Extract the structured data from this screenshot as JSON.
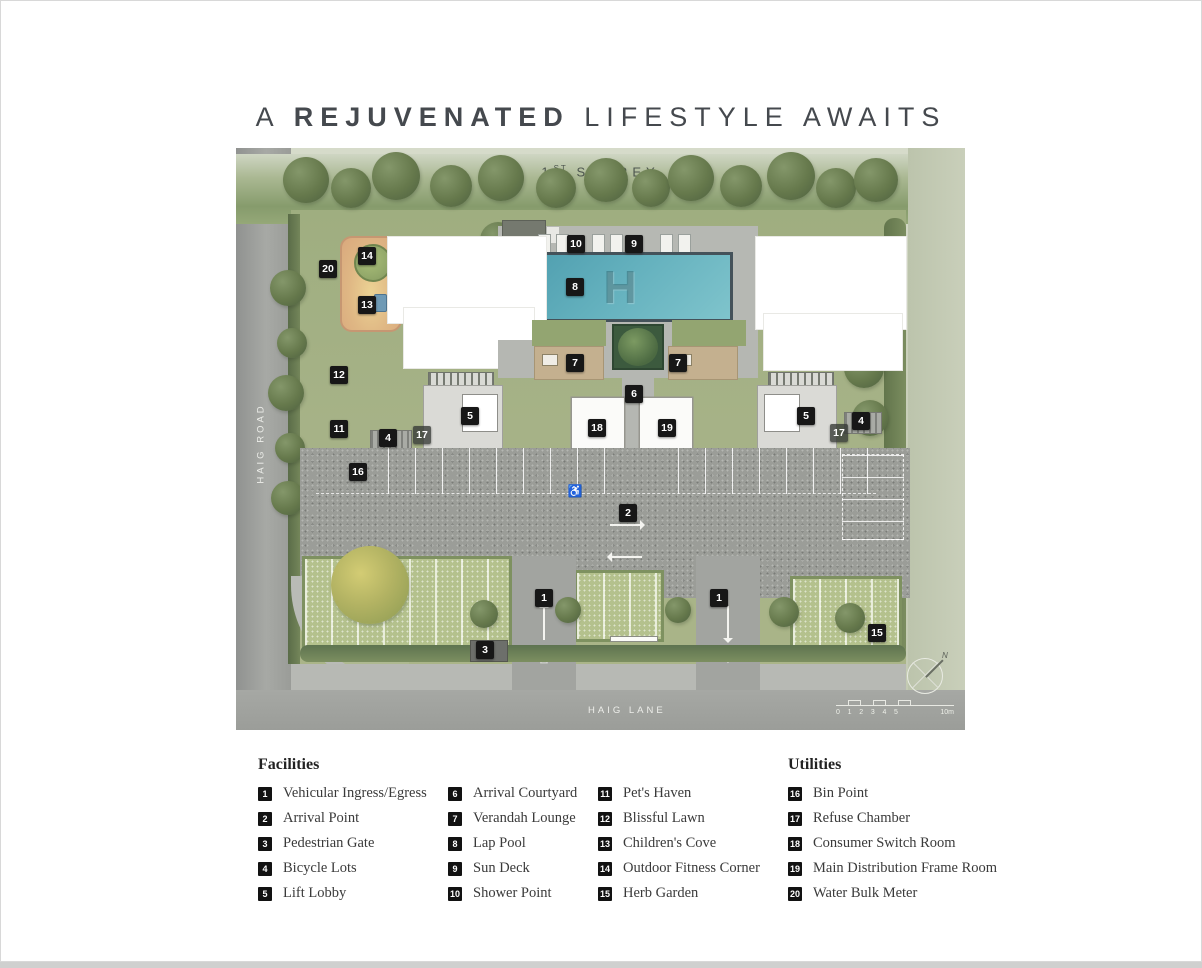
{
  "title": {
    "prefix": "A",
    "emphasis": "REJUVENATED",
    "suffix": "LIFESTYLE AWAITS"
  },
  "plan": {
    "storey_num": "1",
    "storey_sup": "ST",
    "storey_word": "STOREY",
    "road_left": "HAIG ROAD",
    "road_bottom": "HAIG LANE",
    "pool_monogram": "H",
    "ingress_label": "INGRESS",
    "egress_label": "EGRESS",
    "ingress_triangle": "△",
    "egress_triangle": "▽",
    "wheelchair_icon": "♿",
    "compass_n": "N",
    "scale": {
      "ticks": [
        "0",
        "1",
        "2",
        "3",
        "4",
        "5"
      ],
      "end_label": "10m"
    },
    "markers": [
      {
        "n": "20",
        "x": 92,
        "y": 121
      },
      {
        "n": "14",
        "x": 131,
        "y": 108
      },
      {
        "n": "13",
        "x": 131,
        "y": 157
      },
      {
        "n": "10",
        "x": 340,
        "y": 96
      },
      {
        "n": "9",
        "x": 398,
        "y": 96
      },
      {
        "n": "8",
        "x": 339,
        "y": 139
      },
      {
        "n": "7",
        "x": 339,
        "y": 215
      },
      {
        "n": "7",
        "x": 442,
        "y": 215
      },
      {
        "n": "6",
        "x": 398,
        "y": 246
      },
      {
        "n": "12",
        "x": 103,
        "y": 227
      },
      {
        "n": "11",
        "x": 103,
        "y": 281
      },
      {
        "n": "5",
        "x": 234,
        "y": 268
      },
      {
        "n": "17",
        "x": 186,
        "y": 287,
        "muted": true
      },
      {
        "n": "4",
        "x": 152,
        "y": 290
      },
      {
        "n": "18",
        "x": 361,
        "y": 280
      },
      {
        "n": "19",
        "x": 431,
        "y": 280
      },
      {
        "n": "5",
        "x": 570,
        "y": 268
      },
      {
        "n": "17",
        "x": 603,
        "y": 285,
        "muted": true
      },
      {
        "n": "4",
        "x": 625,
        "y": 273
      },
      {
        "n": "16",
        "x": 122,
        "y": 324
      },
      {
        "n": "2",
        "x": 392,
        "y": 365
      },
      {
        "n": "1",
        "x": 308,
        "y": 450
      },
      {
        "n": "1",
        "x": 483,
        "y": 450
      },
      {
        "n": "3",
        "x": 249,
        "y": 502
      },
      {
        "n": "15",
        "x": 641,
        "y": 485
      }
    ]
  },
  "legend": {
    "facilities_title": "Facilities",
    "utilities_title": "Utilities",
    "facilities": [
      {
        "num": "1",
        "label": "Vehicular Ingress/Egress"
      },
      {
        "num": "2",
        "label": "Arrival Point"
      },
      {
        "num": "3",
        "label": "Pedestrian Gate"
      },
      {
        "num": "4",
        "label": "Bicycle Lots"
      },
      {
        "num": "5",
        "label": "Lift Lobby"
      },
      {
        "num": "6",
        "label": "Arrival Courtyard"
      },
      {
        "num": "7",
        "label": "Verandah Lounge"
      },
      {
        "num": "8",
        "label": "Lap Pool"
      },
      {
        "num": "9",
        "label": "Sun Deck"
      },
      {
        "num": "10",
        "label": "Shower Point"
      },
      {
        "num": "11",
        "label": "Pet's Haven"
      },
      {
        "num": "12",
        "label": "Blissful Lawn"
      },
      {
        "num": "13",
        "label": "Children's Cove"
      },
      {
        "num": "14",
        "label": "Outdoor Fitness Corner"
      },
      {
        "num": "15",
        "label": "Herb Garden"
      }
    ],
    "utilities": [
      {
        "num": "16",
        "label": "Bin Point"
      },
      {
        "num": "17",
        "label": "Refuse Chamber"
      },
      {
        "num": "18",
        "label": "Consumer Switch Room"
      },
      {
        "num": "19",
        "label": "Main Distribution Frame Room"
      },
      {
        "num": "20",
        "label": "Water Bulk Meter"
      }
    ]
  },
  "colors": {
    "title_text": "#45494e",
    "marker_bg": "#171717",
    "pool": "#57a4b4",
    "site_green": "#a4b183",
    "road_gray": "#9d9f9b",
    "paver_green": "#b4c18d",
    "cove_tan": "#d9a87d",
    "legend_text": "#3a3a3a"
  }
}
